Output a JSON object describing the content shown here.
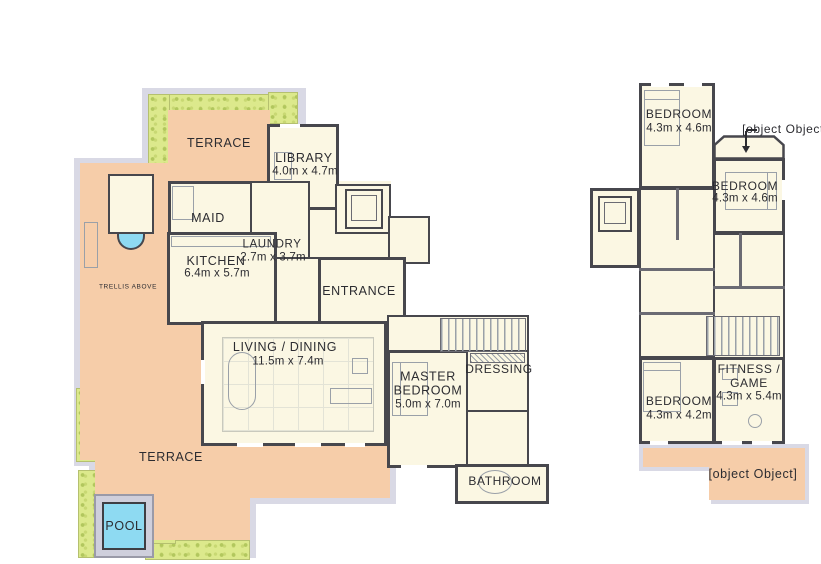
{
  "document_type": "residential floor plans, two levels side by side",
  "palette": {
    "paper": "#ffffff",
    "ink": "#2c2c31",
    "wall": "#47474d",
    "wall2": "#6b6b73",
    "floor": "#fbf7e3",
    "terrace": "#f6cda9",
    "plant": "#dce98c",
    "plant-dot": "#b2c75e",
    "band": "#d9d9e5",
    "pool": "#8edaf2",
    "deck": "#cfcfdc",
    "furn": "#9aa0a8"
  },
  "ground": {
    "terrace_top": "TERRACE",
    "library": {
      "name": "LIBRARY",
      "dims": "4.0m x 4.7m"
    },
    "maid": {
      "name": "MAID"
    },
    "kitchen": {
      "name": "KITCHEN",
      "dims": "6.4m x 5.7m"
    },
    "laundry": {
      "name": "LAUNDRY",
      "dims": "2.7m x 3.7m"
    },
    "entrance": {
      "name": "ENTRANCE"
    },
    "living": {
      "name": "LIVING / DINING",
      "dims": "11.5m x 7.4m"
    },
    "master": {
      "name": "MASTER BEDROOM",
      "dims": "5.0m x 7.0m"
    },
    "dressing": {
      "name": "DRESSING"
    },
    "bathroom": {
      "name": "BATHROOM"
    },
    "terrace_main": "TERRACE",
    "pool": "POOL",
    "trellis_note": "TRELLIS ABOVE"
  },
  "upper": {
    "bedroom_top": {
      "name": "BEDROOM",
      "dims": "4.3m x 4.6m"
    },
    "balcony_top": {
      "name": "BALCONY"
    },
    "bedroom_right": {
      "name": "BEDROOM",
      "dims": "4.3m x 4.6m"
    },
    "fitness": {
      "name": "FITNESS / GAME",
      "dims": "4.3m x 5.4m"
    },
    "bedroom_bottom": {
      "name": "BEDROOM",
      "dims": "4.3m x 4.2m"
    },
    "balcony_bottom": {
      "name": "BALCONY"
    }
  }
}
